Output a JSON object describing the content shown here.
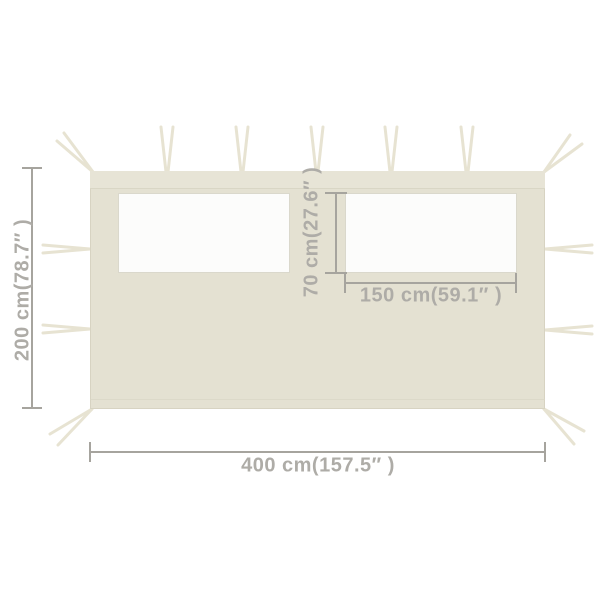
{
  "diagram": {
    "subject": "gazebo-sidewall-with-windows",
    "labels": {
      "height": "200 cm(78.7″ )",
      "width": "400 cm(157.5″ )",
      "window_height": "70 cm(27.6″ )",
      "window_width": "150 cm(59.1″ )"
    },
    "counts": {
      "windows": 2,
      "top_straps": 5,
      "side_straps_per_side": 2,
      "corner_straps": 4
    }
  },
  "colors": {
    "background": "#ffffff",
    "panel": "#e4e1d2",
    "panel_top_band": "#e7e4d6",
    "seam": "#d9d6c5",
    "strap": "#e7e3d2",
    "window": "#fcfcfb",
    "dimension_line": "#a6a49e",
    "dimension_text": "#aeaca7"
  }
}
